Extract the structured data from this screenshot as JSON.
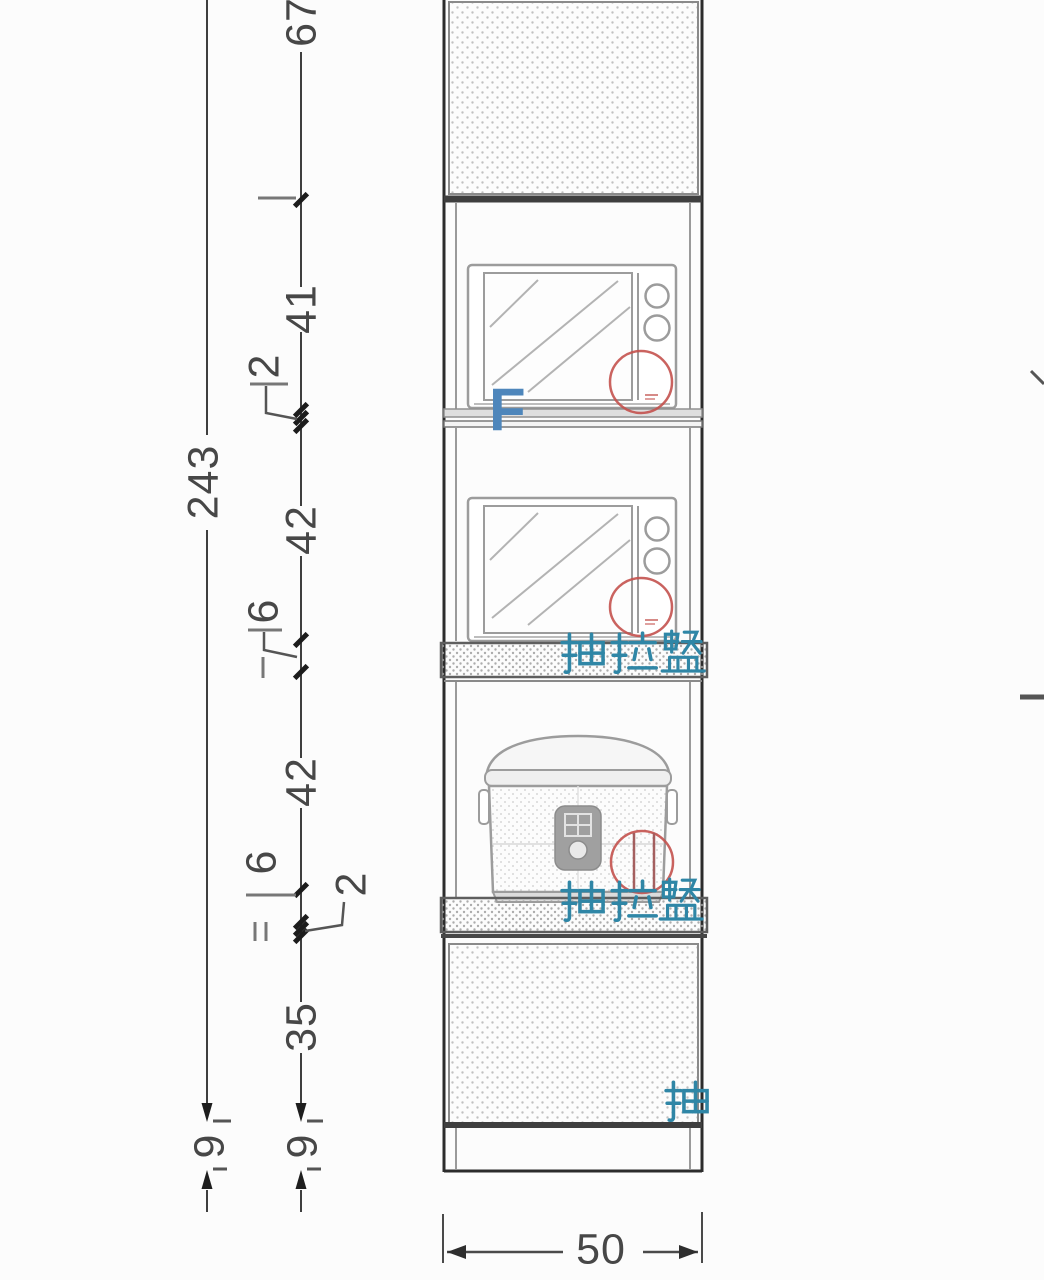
{
  "drawing": {
    "type": "cabinet-elevation",
    "unit": "cm",
    "overall": {
      "height": "243",
      "width": "50",
      "base_height": "9"
    },
    "vertical_chain": {
      "total": "243",
      "segments_top_to_bottom": [
        "67",
        "41",
        "2",
        "42",
        "6",
        "42",
        "6",
        "2",
        "35"
      ],
      "base": "9"
    },
    "dim_labels": {
      "d67": "67",
      "d41": "41",
      "d2a": "2",
      "d243": "243",
      "d42a": "42",
      "d6a": "6",
      "d42b": "42",
      "d6b": "6",
      "d2b": "2",
      "d35": "35",
      "d9a": "9",
      "d9b": "9",
      "d50": "50"
    },
    "annotations": {
      "tray1": "抽拉盤",
      "tray2": "抽拉盤",
      "tray_partial": "抽",
      "blue_mark": "F"
    },
    "colors": {
      "annotation_teal": "#2f86a6",
      "annotation_red": "#c4524e",
      "annotation_blue": "#4e86bb",
      "line_dark": "#3f3f3f",
      "line_gray": "#9a9a9a"
    }
  }
}
